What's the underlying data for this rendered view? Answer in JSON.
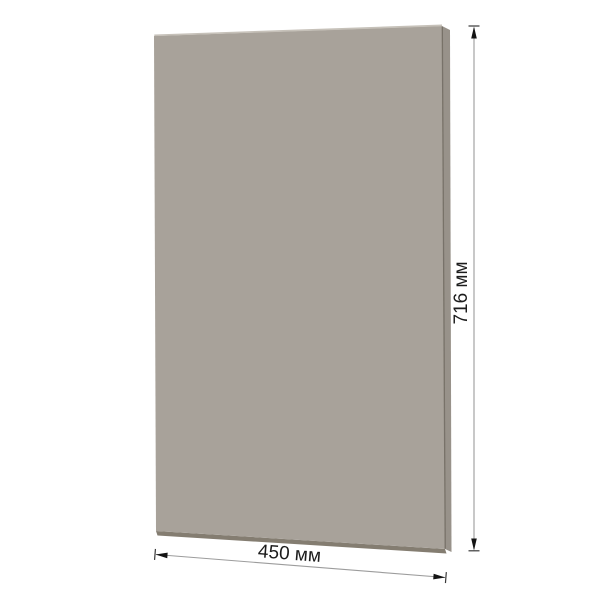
{
  "page": {
    "background": "#ffffff"
  },
  "diagram": {
    "kind": "panel-dimension-drawing",
    "panel": {
      "front_color": "#a8a29a",
      "top_edge_color": "#c6c1b9",
      "side_color": "#98928a",
      "side_crease_color": "#716b61",
      "bottom_color": "#847d71"
    },
    "dimension_lines": {
      "line_color": "#9c9c9c",
      "arrow_color": "#141414",
      "tick_color": "#3a3a3a"
    },
    "labels": {
      "height_label": "716 мм",
      "width_label": "450 мм",
      "height_mm": "716",
      "width_mm": "450",
      "unit": "мм",
      "color": "#1c1c1c"
    }
  }
}
